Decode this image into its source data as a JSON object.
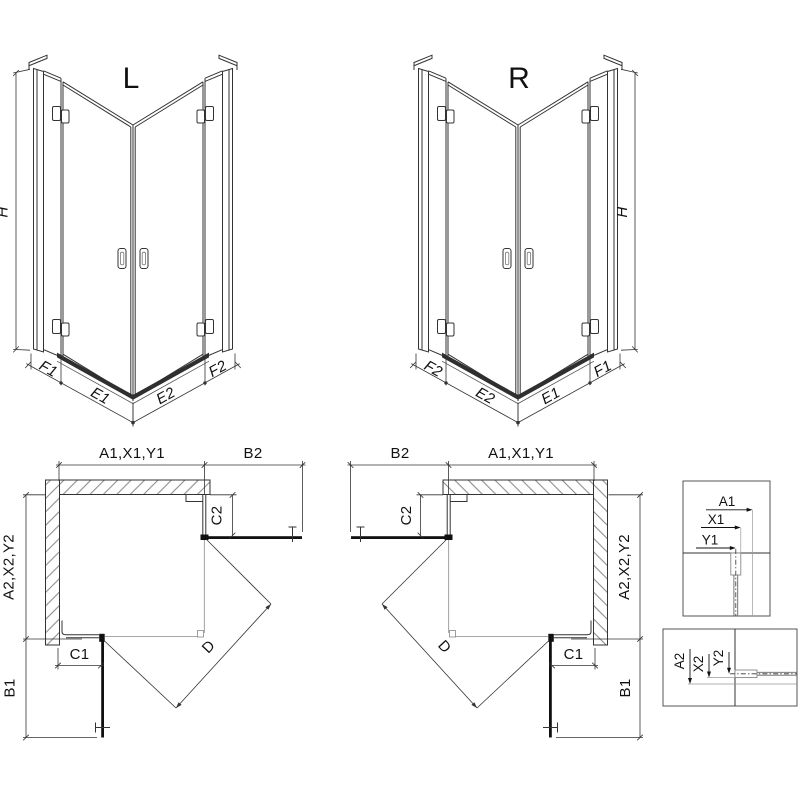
{
  "drawing": {
    "views": {
      "iso_left": {
        "title": "L"
      },
      "iso_right": {
        "title": "R"
      }
    },
    "labels": {
      "height": "H",
      "fixed1": "F1",
      "door1": "E1",
      "door2": "E2",
      "fixed2": "F2",
      "top_width": "A1,X1,Y1",
      "door_proj_top": "B2",
      "fixed_top": "C2",
      "side_width": "A2,X2,Y2",
      "fixed_side": "C1",
      "door_proj_side": "B1",
      "diagonal": "D"
    },
    "details": {
      "top": {
        "a": "A1",
        "x": "X1",
        "y": "Y1"
      },
      "bottom": {
        "a": "A2",
        "x": "X2",
        "y": "Y2"
      }
    },
    "colors": {
      "line": "#333333",
      "dark": "#111111",
      "hatch": "#777777",
      "tray": "#2f2f2f",
      "thin": "#888888"
    }
  }
}
